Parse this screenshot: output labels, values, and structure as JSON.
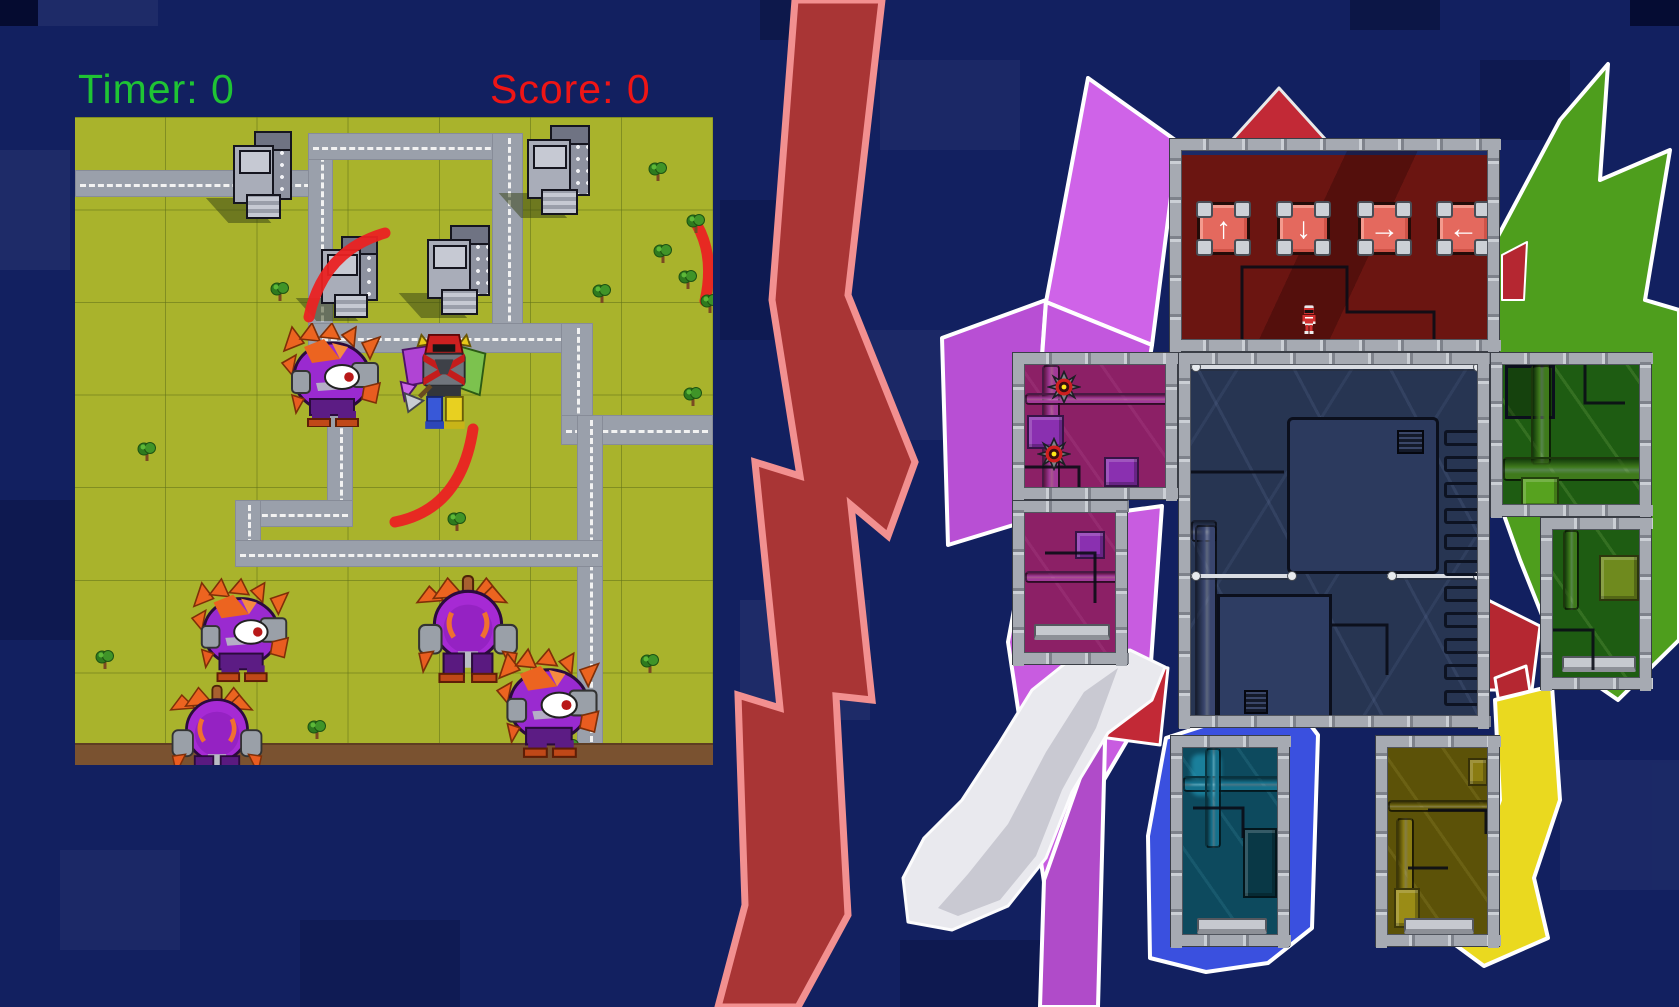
{
  "hud": {
    "timer": "Timer: 0",
    "score": "Score: 0",
    "timer_color": "#1fc434",
    "score_color": "#ef1515"
  },
  "dpad": [
    {
      "dir": "up",
      "glyph": "↑",
      "x": 15,
      "y": 51
    },
    {
      "dir": "down",
      "glyph": "↓",
      "x": 95,
      "y": 51
    },
    {
      "dir": "right",
      "glyph": "→",
      "x": 176,
      "y": 51
    },
    {
      "dir": "left",
      "glyph": "←",
      "x": 255,
      "y": 51
    }
  ],
  "colors": {
    "bg": "#122060",
    "grass": "#a9b32c",
    "road": "#9aa0ab",
    "road_line": "#f2f2f2",
    "soil": "#7a5230",
    "bolt_fill": "#a93535",
    "bolt_stroke": "#f29090",
    "head": "#6b1511",
    "torso": "#273552",
    "arm_left": "#8c2066",
    "arm_right": "#1e5c12",
    "leg_left": "#0d4a5e",
    "leg_right": "#5c5208"
  },
  "bg_blocks": [
    {
      "x": 0,
      "y": 0,
      "w": 38,
      "h": 26,
      "c": "rgba(3,8,40,0.85)"
    },
    {
      "x": 38,
      "y": 0,
      "w": 120,
      "h": 26,
      "c": "rgba(255,255,255,0.05)"
    },
    {
      "x": 760,
      "y": 0,
      "w": 110,
      "h": 40,
      "c": "rgba(0,0,10,0.25)"
    },
    {
      "x": 1350,
      "y": 0,
      "w": 90,
      "h": 30,
      "c": "rgba(0,0,10,0.3)"
    },
    {
      "x": 1630,
      "y": 0,
      "w": 49,
      "h": 26,
      "c": "rgba(3,8,40,0.8)"
    },
    {
      "x": 880,
      "y": 60,
      "w": 140,
      "h": 90,
      "c": "rgba(255,255,255,0.04)"
    },
    {
      "x": 0,
      "y": 150,
      "w": 70,
      "h": 120,
      "c": "rgba(255,255,255,0.05)"
    },
    {
      "x": 720,
      "y": 200,
      "w": 120,
      "h": 140,
      "c": "rgba(0,0,20,0.18)"
    },
    {
      "x": 860,
      "y": 330,
      "w": 100,
      "h": 110,
      "c": "rgba(255,255,255,0.04)"
    },
    {
      "x": 0,
      "y": 500,
      "w": 75,
      "h": 140,
      "c": "rgba(0,0,20,0.2)"
    },
    {
      "x": 740,
      "y": 600,
      "w": 130,
      "h": 120,
      "c": "rgba(255,255,255,0.05)"
    },
    {
      "x": 900,
      "y": 940,
      "w": 160,
      "h": 67,
      "c": "rgba(0,0,20,0.2)"
    },
    {
      "x": 1560,
      "y": 760,
      "w": 119,
      "h": 130,
      "c": "rgba(255,255,255,0.04)"
    },
    {
      "x": 1480,
      "y": 60,
      "w": 90,
      "h": 80,
      "c": "rgba(0,0,20,0.2)"
    },
    {
      "x": 60,
      "y": 850,
      "w": 120,
      "h": 100,
      "c": "rgba(255,255,255,0.04)"
    },
    {
      "x": 300,
      "y": 920,
      "w": 160,
      "h": 87,
      "c": "rgba(0,0,20,0.15)"
    }
  ],
  "shapes": [
    {
      "name": "origami-magenta-petal",
      "pts": "1088,78 1178,142 1152,345 1046,302",
      "fill": "#cf63e8",
      "stroke": "#ffffff",
      "sw": 4
    },
    {
      "name": "origami-magenta-petal",
      "pts": "942,338 1046,300 1030,520 948,545",
      "fill": "#b84fd4",
      "stroke": "#ffffff",
      "sw": 4
    },
    {
      "name": "origami-magenta-petal",
      "pts": "1046,302 1152,345 1126,502 1030,522",
      "fill": "#c257dd",
      "stroke": "#ffffff",
      "sw": 4
    },
    {
      "name": "origami-magenta-petal",
      "pts": "1030,524 1162,506 1148,705 1044,882 1008,642",
      "fill": "#c85ce0",
      "stroke": "#ffffff",
      "sw": 4
    },
    {
      "name": "origami-magenta-petal",
      "pts": "1044,880 1106,704 1098,1007 1040,1007",
      "fill": "#b04bc9",
      "stroke": "#ffffff",
      "sw": 4
    },
    {
      "name": "origami-green",
      "pts": "1448,330 1560,120 1608,64 1600,180 1670,150 1645,300 1679,310 1679,640 1618,700 1560,660 1520,560 1470,420",
      "fill": "#4e9e1d",
      "stroke": "#ffffff",
      "sw": 4
    },
    {
      "name": "origami-red",
      "pts": "1232,140 1279,88 1326,140",
      "fill": "#c22936",
      "stroke": "#e9e9e9",
      "sw": 3
    },
    {
      "name": "origami-red",
      "pts": "1502,255 1527,242 1524,300 1502,300",
      "fill": "#b52731",
      "stroke": "#ffffff",
      "sw": 2
    },
    {
      "name": "origami-red",
      "pts": "1488,600 1540,626 1532,690 1488,690",
      "fill": "#b52731",
      "stroke": "#ffffff",
      "sw": 3
    },
    {
      "name": "origami-red",
      "pts": "1100,655 1168,668 1160,745 1085,735",
      "fill": "#c22936",
      "stroke": "#ffffff",
      "sw": 3
    },
    {
      "name": "origami-red",
      "pts": "1495,678 1526,666 1532,704 1500,710",
      "fill": "#b52731",
      "stroke": "#ffffff",
      "sw": 3
    },
    {
      "name": "origami-glove",
      "pts": "1130,650 1165,667 1152,700 1108,733 1072,792 1046,858 1008,906 952,930 908,922 903,878 924,838 962,800 998,745 1032,690 1072,658",
      "fill": "#e9e9ee",
      "stroke": "#fcfcfd",
      "sw": 3
    },
    {
      "name": "origami-glove-shade",
      "pts": "1118,668 1096,728 1062,790 1036,856 1000,900 958,916 938,908 968,874 1008,824 1046,752 1084,692",
      "fill": "#c9c9d2",
      "stroke": "none",
      "sw": 0
    },
    {
      "name": "origami-blue",
      "pts": "1148,836 1166,738 1290,698 1318,735 1312,928 1268,963 1206,972 1150,958",
      "fill": "#3a50df",
      "stroke": "#ffffff",
      "sw": 4
    },
    {
      "name": "origami-yellow",
      "pts": "1495,700 1552,686 1560,800 1534,878 1548,938 1484,966 1446,938 1492,898 1478,860 1500,800",
      "fill": "#ead91f",
      "stroke": "#ffffff",
      "sw": 4
    }
  ],
  "bolt": {
    "pts": "795,0 882,0 848,295 915,462 888,536 851,505 872,700 836,696 848,915 798,1007 718,1007 745,905 738,695 780,708 755,462 800,476 772,300"
  },
  "map": {
    "roads": [
      {
        "d": "h",
        "x": 0,
        "y": 53,
        "w": 258,
        "h": 27
      },
      {
        "d": "v",
        "x": 233,
        "y": 16,
        "w": 25,
        "h": 220
      },
      {
        "d": "h",
        "x": 233,
        "y": 16,
        "w": 215,
        "h": 27
      },
      {
        "d": "v",
        "x": 417,
        "y": 16,
        "w": 31,
        "h": 220
      },
      {
        "d": "h",
        "x": 233,
        "y": 206,
        "w": 285,
        "h": 30
      },
      {
        "d": "v",
        "x": 486,
        "y": 206,
        "w": 32,
        "h": 122
      },
      {
        "d": "h",
        "x": 486,
        "y": 298,
        "w": 152,
        "h": 30
      },
      {
        "d": "v",
        "x": 502,
        "y": 298,
        "w": 26,
        "h": 350
      },
      {
        "d": "v",
        "x": 252,
        "y": 236,
        "w": 26,
        "h": 174
      },
      {
        "d": "h",
        "x": 173,
        "y": 383,
        "w": 105,
        "h": 27
      },
      {
        "d": "v",
        "x": 160,
        "y": 383,
        "w": 26,
        "h": 67
      },
      {
        "d": "h",
        "x": 160,
        "y": 423,
        "w": 368,
        "h": 27
      }
    ],
    "buildings": [
      {
        "x": 158,
        "y": 14,
        "w": 60,
        "h": 88
      },
      {
        "x": 452,
        "y": 8,
        "w": 64,
        "h": 90
      },
      {
        "x": 246,
        "y": 119,
        "w": 58,
        "h": 82
      },
      {
        "x": 352,
        "y": 108,
        "w": 64,
        "h": 90
      }
    ],
    "slashes": [
      {
        "d": "M310,116 Q248,134 234,200"
      },
      {
        "d": "M398,312 Q386,392 320,405"
      },
      {
        "d": "M622,108 Q640,140 630,184"
      }
    ],
    "trees": [
      {
        "x": 573,
        "y": 43
      },
      {
        "x": 611,
        "y": 95
      },
      {
        "x": 517,
        "y": 165
      },
      {
        "x": 603,
        "y": 151
      },
      {
        "x": 625,
        "y": 175
      },
      {
        "x": 62,
        "y": 323
      },
      {
        "x": 20,
        "y": 531
      },
      {
        "x": 232,
        "y": 601
      },
      {
        "x": 445,
        "y": 623
      },
      {
        "x": 485,
        "y": 620
      },
      {
        "x": 565,
        "y": 535
      },
      {
        "x": 195,
        "y": 163
      },
      {
        "x": 372,
        "y": 393
      },
      {
        "x": 608,
        "y": 268
      },
      {
        "x": 578,
        "y": 125
      }
    ],
    "monsters": [
      {
        "type": "cyclops",
        "x": 205,
        "y": 206,
        "w": 112,
        "h": 104
      },
      {
        "type": "warrior",
        "x": 322,
        "y": 210,
        "w": 94,
        "h": 106
      },
      {
        "type": "cyclops",
        "x": 115,
        "y": 456,
        "w": 110,
        "h": 114
      },
      {
        "type": "back",
        "x": 338,
        "y": 453,
        "w": 110,
        "h": 116
      },
      {
        "type": "back",
        "x": 92,
        "y": 566,
        "w": 100,
        "h": 100
      },
      {
        "type": "cyclops",
        "x": 420,
        "y": 526,
        "w": 116,
        "h": 120
      }
    ]
  },
  "robot": {
    "rooms": [
      {
        "name": "head",
        "x": 1169,
        "y": 138,
        "w": 331,
        "h": 214,
        "skin": "rc-head"
      },
      {
        "name": "arm-left-upper",
        "x": 1012,
        "y": 352,
        "w": 166,
        "h": 148,
        "skin": "rc-armL"
      },
      {
        "name": "arm-left-lower",
        "x": 1012,
        "y": 500,
        "w": 116,
        "h": 165,
        "skin": "rc-armL"
      },
      {
        "name": "torso",
        "x": 1178,
        "y": 352,
        "w": 312,
        "h": 376,
        "skin": "rc-torso"
      },
      {
        "name": "arm-right-upper",
        "x": 1490,
        "y": 352,
        "w": 162,
        "h": 165,
        "skin": "rc-armR"
      },
      {
        "name": "arm-right-lower",
        "x": 1540,
        "y": 517,
        "w": 112,
        "h": 173,
        "skin": "rc-armR"
      },
      {
        "name": "leg-left",
        "x": 1170,
        "y": 735,
        "w": 120,
        "h": 212,
        "skin": "rc-legL"
      },
      {
        "name": "leg-right",
        "x": 1375,
        "y": 735,
        "w": 125,
        "h": 212,
        "skin": "rc-legR"
      }
    ],
    "details": {
      "head": [
        {
          "t": "line",
          "pts": "60,203 60,116 165,116 165,161 252,161 252,203"
        }
      ],
      "torso": [
        {
          "t": "beam",
          "x": 0,
          "y": 0,
          "w": 290
        },
        {
          "t": "panel",
          "x": 96,
          "y": 52,
          "w": 152,
          "h": 157
        },
        {
          "t": "vent",
          "x": 206,
          "y": 65,
          "w": 27,
          "h": 24
        },
        {
          "t": "panel2",
          "x": 26,
          "y": 229,
          "w": 115,
          "h": 125
        },
        {
          "t": "vent",
          "x": 53,
          "y": 325,
          "w": 24,
          "h": 24
        },
        {
          "t": "pipeh",
          "x": 0,
          "y": 155,
          "w": 26,
          "h": 22,
          "c": "#39456e"
        },
        {
          "t": "pipev",
          "x": 4,
          "y": 160,
          "w": 22,
          "h": 194,
          "c": "#39456e"
        },
        {
          "t": "beam",
          "x": 0,
          "y": 209,
          "w": 104
        },
        {
          "t": "beam",
          "x": 196,
          "y": 209,
          "w": 94
        },
        {
          "t": "line",
          "pts": "0,107 93,107"
        },
        {
          "t": "line",
          "pts": "141,260 196,260 196,310"
        }
      ],
      "arm-left-upper": [
        {
          "t": "pipev",
          "x": 17,
          "y": 0,
          "w": 18,
          "h": 126,
          "c": "#a23a98"
        },
        {
          "t": "pipeh",
          "x": 0,
          "y": 28,
          "w": 144,
          "h": 12,
          "c": "#a23a98"
        },
        {
          "t": "crate",
          "x": 2,
          "y": 50,
          "w": 37,
          "h": 34,
          "c": "#8a30b0"
        },
        {
          "t": "crate",
          "x": 79,
          "y": 92,
          "w": 35,
          "h": 30,
          "c": "#8a30b0"
        },
        {
          "t": "line",
          "pts": "0,102 54,102 54,126"
        }
      ],
      "arm-left-lower": [
        {
          "t": "pipeh",
          "x": 0,
          "y": 58,
          "w": 94,
          "h": 12,
          "c": "#a23a98"
        },
        {
          "t": "crate",
          "x": 50,
          "y": 18,
          "w": 30,
          "h": 28,
          "c": "#8a30b0"
        },
        {
          "t": "plat",
          "x": 9,
          "y": 111,
          "w": 76,
          "h": 16
        },
        {
          "t": "line",
          "pts": "20,40 70,40 70,90"
        }
      ],
      "arm-right-upper": [
        {
          "t": "paneldk",
          "x": 2,
          "y": 0,
          "w": 50,
          "h": 54
        },
        {
          "t": "pipev",
          "x": 28,
          "y": 0,
          "w": 20,
          "h": 100,
          "c": "#3f7a1c"
        },
        {
          "t": "pipeh",
          "x": 0,
          "y": 92,
          "w": 140,
          "h": 24,
          "c": "#3f7a1c"
        },
        {
          "t": "crate",
          "x": 18,
          "y": 112,
          "w": 38,
          "h": 31,
          "c": "#57a21f"
        },
        {
          "t": "line",
          "pts": "82,0 82,38 122,38"
        }
      ],
      "arm-right-lower": [
        {
          "t": "pipev",
          "x": 10,
          "y": 0,
          "w": 16,
          "h": 80,
          "c": "#3f7a1c"
        },
        {
          "t": "crate",
          "x": 46,
          "y": 25,
          "w": 40,
          "h": 46,
          "c": "#6f8a1e"
        },
        {
          "t": "plat",
          "x": 9,
          "y": 126,
          "w": 74,
          "h": 16
        },
        {
          "t": "line",
          "pts": "0,100 40,100 40,140"
        }
      ],
      "leg-left": [
        {
          "t": "glow",
          "x": 8,
          "y": 6,
          "w": 30,
          "h": 42,
          "c": "rgba(40,180,215,0.5)"
        },
        {
          "t": "pipeh",
          "x": 0,
          "y": 28,
          "w": 98,
          "h": 16,
          "c": "#15718c"
        },
        {
          "t": "pipev",
          "x": 22,
          "y": 0,
          "w": 16,
          "h": 100,
          "c": "#15718c"
        },
        {
          "t": "crate",
          "x": 60,
          "y": 80,
          "w": 34,
          "h": 70,
          "c": "#093846"
        },
        {
          "t": "plat",
          "x": 14,
          "y": 170,
          "w": 70,
          "h": 16
        },
        {
          "t": "line",
          "pts": "10,60 60,60 60,90"
        }
      ],
      "leg-right": [
        {
          "t": "crate",
          "x": 80,
          "y": 10,
          "w": 20,
          "h": 28,
          "c": "#8a7c12"
        },
        {
          "t": "pipev",
          "x": 8,
          "y": 70,
          "w": 18,
          "h": 110,
          "c": "#8a7c12"
        },
        {
          "t": "pipeh",
          "x": 0,
          "y": 52,
          "w": 103,
          "h": 12,
          "c": "#6e6410"
        },
        {
          "t": "crate",
          "x": 6,
          "y": 140,
          "w": 26,
          "h": 40,
          "c": "#9a8c16"
        },
        {
          "t": "plat",
          "x": 16,
          "y": 170,
          "w": 70,
          "h": 16
        },
        {
          "t": "line",
          "pts": "40,62 98,62 98,86"
        },
        {
          "t": "line",
          "pts": "20,120 60,120"
        }
      ]
    },
    "ladder": {
      "room": "torso",
      "x": 253,
      "y": 65,
      "n": 12,
      "gap": 26,
      "w": 44
    },
    "saws": [
      {
        "x": 39,
        "y": 22
      },
      {
        "x": 29,
        "y": 89
      }
    ],
    "ranger": {
      "x": 117,
      "y": 144,
      "w": 20,
      "h": 48
    }
  }
}
